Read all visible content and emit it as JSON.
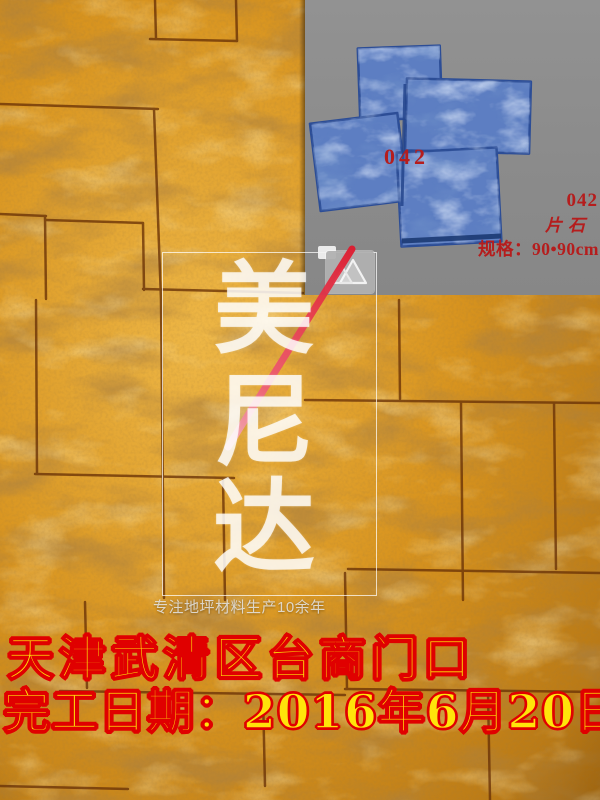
{
  "overlay": {
    "location_line": "天津武清区台商门口",
    "date_line": "完工日期：2016年6月20日",
    "fill_color": "#ffe40a",
    "outline_color": "#e00000"
  },
  "product_panel": {
    "panel_bg_color": "#8b8b8b",
    "mold_blue_color": "#5d7ec2",
    "label_red_color": "#b51d1d",
    "mold_number": "042",
    "side_number": "042",
    "stone_type": "片石",
    "spec_line": "规格：90•90cm"
  },
  "watermark": {
    "brand_chars": [
      "美",
      "尼",
      "达"
    ],
    "tagline": "专注地坪材料生产10余年",
    "logo_icon": "mountain-logo",
    "slash_color_top": "#e0182c",
    "slash_color_bottom": "#f6b3c3",
    "text_color": "rgba(255,255,255,0.8)"
  },
  "floor": {
    "subject": "stamped-concrete-ashlar-floor",
    "base_color": "#d8941f",
    "grout_color": "#6a3206"
  }
}
